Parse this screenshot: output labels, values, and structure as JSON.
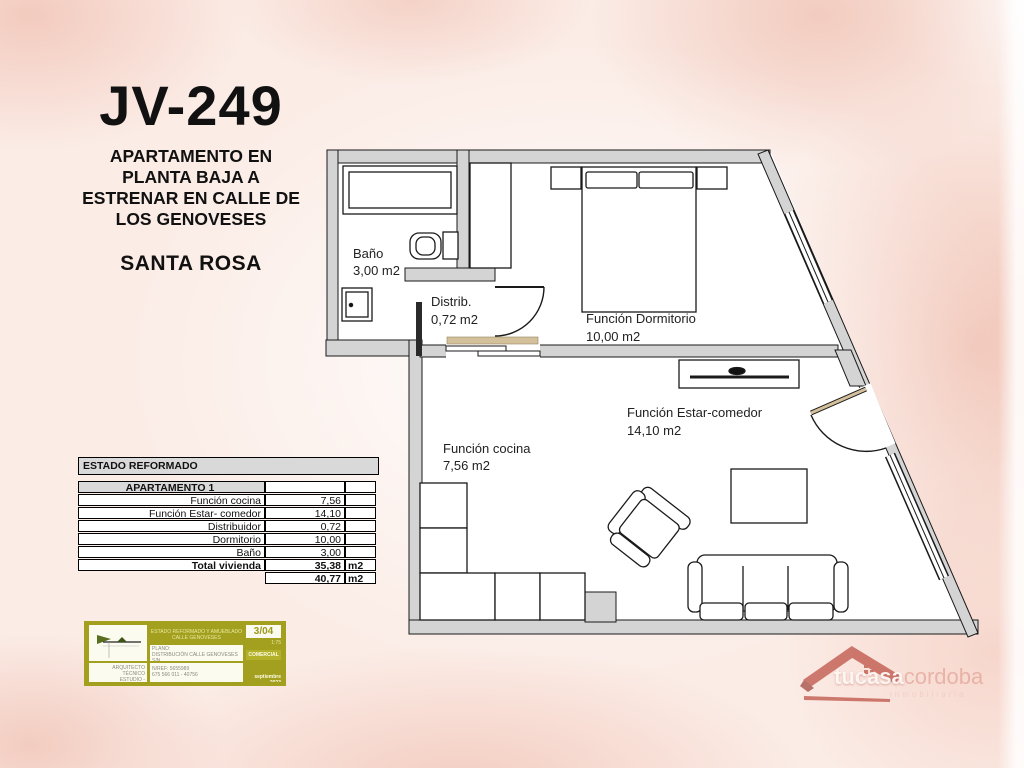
{
  "header": {
    "code": "JV-249",
    "subtitle_lines": [
      "APARTAMENTO EN",
      "PLANTA BAJA A",
      "ESTRENAR EN CALLE DE",
      "LOS GENOVESES"
    ],
    "location": "SANTA ROSA"
  },
  "table": {
    "title": "ESTADO REFORMADO",
    "header": "APARTAMENTO 1",
    "rows": [
      {
        "label": "Función cocina",
        "value": "7,56",
        "unit": ""
      },
      {
        "label": "Función Estar- comedor",
        "value": "14,10",
        "unit": ""
      },
      {
        "label": "Distribuidor",
        "value": "0,72",
        "unit": ""
      },
      {
        "label": "Dormitorio",
        "value": "10,00",
        "unit": ""
      },
      {
        "label": "Baño",
        "value": "3,00",
        "unit": ""
      },
      {
        "label": "Total vivienda",
        "value": "35,38",
        "unit": "m2"
      }
    ],
    "footer": {
      "value": "40,77",
      "unit": "m2"
    }
  },
  "plan": {
    "rooms": {
      "bano": {
        "name": "Baño",
        "area": "3,00 m2"
      },
      "distribuidor": {
        "name": "Distrib.",
        "area": "0,72 m2"
      },
      "dormitorio": {
        "name": "Función Dormitorio",
        "area": "10,00 m2"
      },
      "cocina": {
        "name": "Función cocina",
        "area": "7,56 m2"
      },
      "estar_comedor": {
        "name": "Función Estar-comedor",
        "area": "14,10 m2"
      }
    }
  },
  "titleblock": {
    "sheet": "3/04",
    "scale": "1:75",
    "stage": "COMERCIAL",
    "date": "septiembre 2023",
    "project_line1": "ESTADO REFORMADO Y AMUEBLADO",
    "project_line2": "CALLE GENOVESES",
    "mid_line1": "PLANO:",
    "mid_line2": "DISTRIBUCIÓN CALLE GENOVESES S/N",
    "mid_line3": "ESTADO REFORMADO DE LA VIVIENDA",
    "bottom_line1": "N/REF: 5655989",
    "bottom_line2": "675 566 011 - 40756",
    "left_line1": "ARQUITECTO TÉCNICO",
    "left_line2": "ESTUDIO - DELINEACIÓN"
  },
  "logo": {
    "brand": "tucasa",
    "brand_suffix": "cordoba",
    "tagline": "inmobiliaria"
  },
  "colors": {
    "background_pink": "#fbece6",
    "salmon_patch": "#f0c0b1",
    "wall_gray": "#d4d4d4",
    "threshold_tan": "#d5c09c",
    "cartouche_olive": "#a2a01e",
    "logo_red": "#b23427",
    "table_header_gray": "#d9d9d9"
  }
}
